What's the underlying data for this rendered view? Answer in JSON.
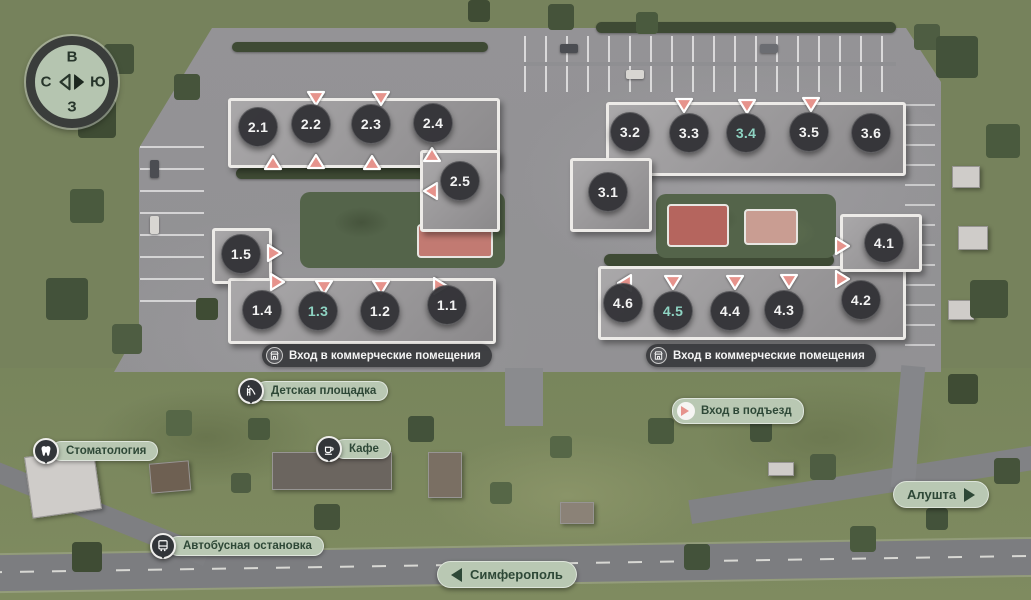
{
  "compass": {
    "top": "В",
    "left": "С",
    "right": "Ю",
    "bottom": "З"
  },
  "map": {
    "colors": {
      "marker_bg": "#313236",
      "marker_text": "#f3f3f3",
      "marker_highlight": "#8ed3c2",
      "entrance_fill": "#e6938c",
      "pill_dark_bg": "#3a3b3e",
      "pill_light_bg": "#b9c8b3",
      "pill_light_text": "#2e4837"
    },
    "buildings": [
      {
        "label": "2.1",
        "x": 258,
        "y": 127,
        "highlighted": false
      },
      {
        "label": "2.2",
        "x": 311,
        "y": 124,
        "highlighted": false
      },
      {
        "label": "2.3",
        "x": 371,
        "y": 124,
        "highlighted": false
      },
      {
        "label": "2.4",
        "x": 433,
        "y": 123,
        "highlighted": false
      },
      {
        "label": "2.5",
        "x": 460,
        "y": 181,
        "highlighted": false
      },
      {
        "label": "1.5",
        "x": 241,
        "y": 254,
        "highlighted": false
      },
      {
        "label": "1.4",
        "x": 262,
        "y": 310,
        "highlighted": false
      },
      {
        "label": "1.3",
        "x": 318,
        "y": 311,
        "highlighted": true
      },
      {
        "label": "1.2",
        "x": 380,
        "y": 311,
        "highlighted": false
      },
      {
        "label": "1.1",
        "x": 447,
        "y": 305,
        "highlighted": false
      },
      {
        "label": "3.1",
        "x": 608,
        "y": 192,
        "highlighted": false
      },
      {
        "label": "3.2",
        "x": 630,
        "y": 132,
        "highlighted": false
      },
      {
        "label": "3.3",
        "x": 689,
        "y": 133,
        "highlighted": false
      },
      {
        "label": "3.4",
        "x": 746,
        "y": 133,
        "highlighted": true
      },
      {
        "label": "3.5",
        "x": 809,
        "y": 132,
        "highlighted": false
      },
      {
        "label": "3.6",
        "x": 871,
        "y": 133,
        "highlighted": false
      },
      {
        "label": "4.1",
        "x": 884,
        "y": 243,
        "highlighted": false
      },
      {
        "label": "4.2",
        "x": 861,
        "y": 300,
        "highlighted": false
      },
      {
        "label": "4.3",
        "x": 784,
        "y": 310,
        "highlighted": false
      },
      {
        "label": "4.4",
        "x": 730,
        "y": 311,
        "highlighted": false
      },
      {
        "label": "4.5",
        "x": 673,
        "y": 311,
        "highlighted": true
      },
      {
        "label": "4.6",
        "x": 623,
        "y": 303,
        "highlighted": false
      }
    ],
    "entrances": [
      {
        "x": 316,
        "y": 98,
        "dir": "down"
      },
      {
        "x": 381,
        "y": 98,
        "dir": "down"
      },
      {
        "x": 273,
        "y": 163,
        "dir": "up"
      },
      {
        "x": 316,
        "y": 162,
        "dir": "up"
      },
      {
        "x": 372,
        "y": 163,
        "dir": "up"
      },
      {
        "x": 432,
        "y": 155,
        "dir": "up"
      },
      {
        "x": 431,
        "y": 191,
        "dir": "left"
      },
      {
        "x": 684,
        "y": 105,
        "dir": "down"
      },
      {
        "x": 747,
        "y": 106,
        "dir": "down"
      },
      {
        "x": 811,
        "y": 104,
        "dir": "down"
      },
      {
        "x": 274,
        "y": 253,
        "dir": "right"
      },
      {
        "x": 277,
        "y": 282,
        "dir": "right"
      },
      {
        "x": 324,
        "y": 287,
        "dir": "down"
      },
      {
        "x": 381,
        "y": 287,
        "dir": "down"
      },
      {
        "x": 440,
        "y": 286,
        "dir": "right"
      },
      {
        "x": 625,
        "y": 283,
        "dir": "left"
      },
      {
        "x": 673,
        "y": 282,
        "dir": "down"
      },
      {
        "x": 735,
        "y": 282,
        "dir": "down"
      },
      {
        "x": 789,
        "y": 281,
        "dir": "down"
      },
      {
        "x": 842,
        "y": 246,
        "dir": "right"
      },
      {
        "x": 842,
        "y": 279,
        "dir": "right"
      }
    ],
    "labels": {
      "commercial_left": "Вход в коммерческие помещения",
      "commercial_right": "Вход в коммерческие помещения",
      "playground": "Детская площадка",
      "entrance_legend": "Вход в подъезд",
      "dentistry": "Стоматология",
      "cafe": "Кафе",
      "bus_stop": "Автобусная остановка",
      "road_right": "Алушта",
      "road_bottom": "Симферополь"
    }
  }
}
